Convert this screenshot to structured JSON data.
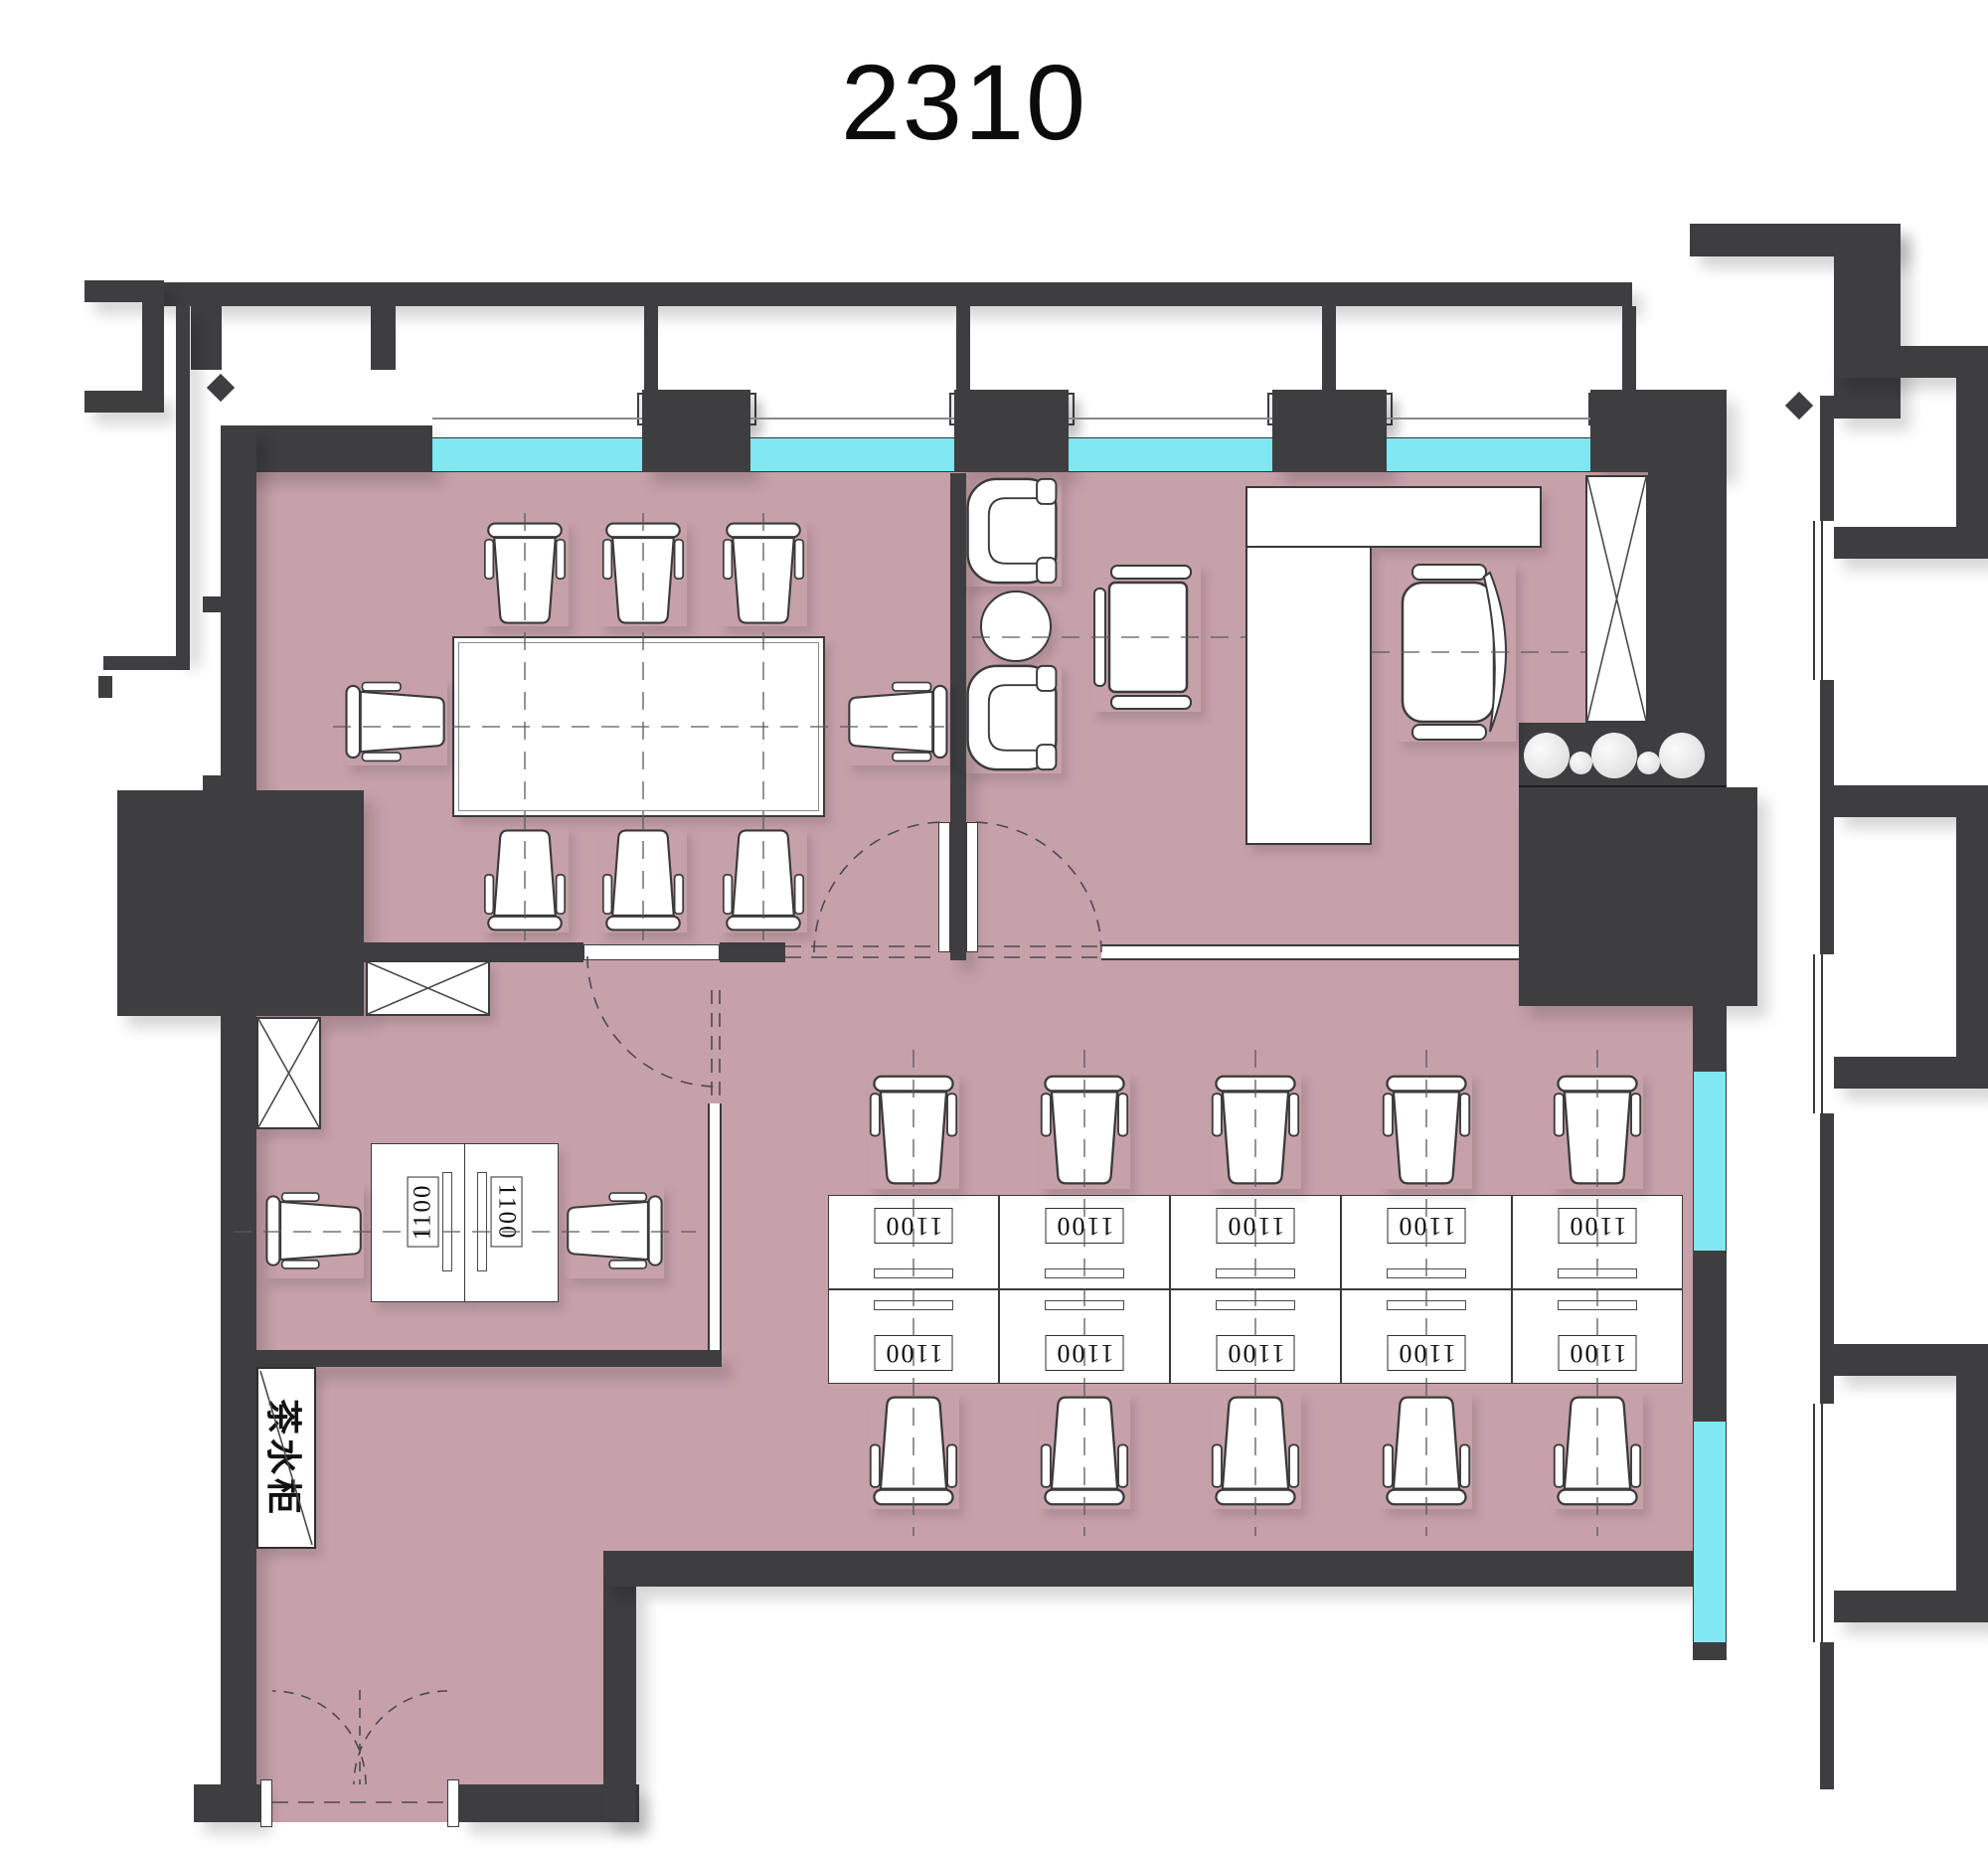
{
  "title": "2310",
  "pantry_cabinet_label": "茶水柜",
  "workstations": {
    "rows": [
      {
        "name": "top",
        "labels": [
          "1100",
          "1100",
          "1100",
          "1100",
          "1100"
        ]
      },
      {
        "name": "bottom",
        "labels": [
          "1100",
          "1100",
          "1100",
          "1100",
          "1100"
        ]
      }
    ]
  },
  "small_office": {
    "desk_labels": [
      "1100",
      "1100"
    ]
  },
  "rooms": [
    "meeting-room",
    "executive-office",
    "open-office",
    "small-office",
    "pantry",
    "entry"
  ],
  "furniture_counts": {
    "meeting_chairs": 8,
    "lounge_armchairs": 2,
    "workstation_chairs": 10,
    "small_office_chairs": 2,
    "sinks": 3
  },
  "colors": {
    "wall": "#3e3e40",
    "floor": "#c7a1aa",
    "window": "#7fe8f1",
    "furniture": "#ffffff",
    "line": "#3a3a3a"
  }
}
